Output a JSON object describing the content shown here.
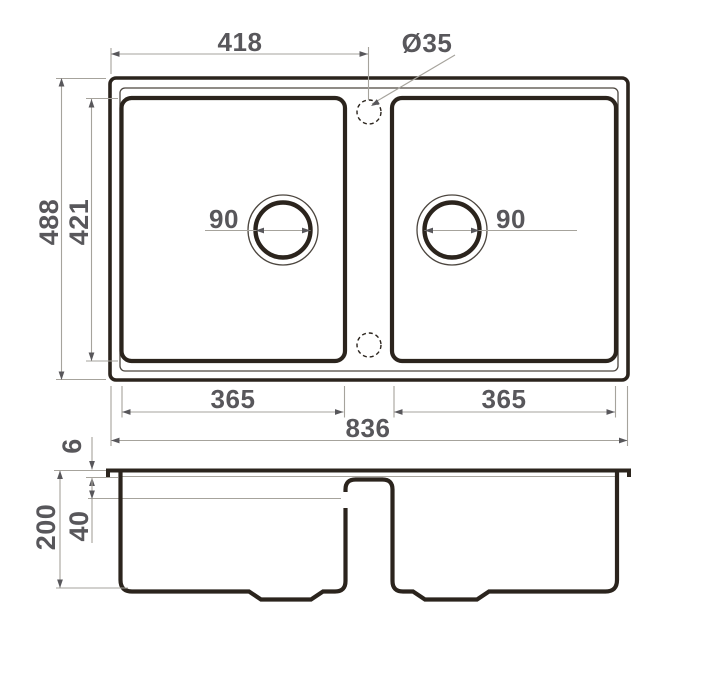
{
  "drawing": {
    "colors": {
      "outline": "#2b241d",
      "dim_text": "#58575b",
      "dim_line": "#a6a39c",
      "background": "#ffffff"
    },
    "top_view": {
      "dim_left_edge_to_hole_center": "418",
      "tap_hole_diameter": "Ø35",
      "dim_overall_depth": "488",
      "dim_bowl_inner_depth": "421",
      "dim_left_drain_diameter": "90",
      "dim_right_drain_diameter": "90",
      "dim_left_bowl_width": "365",
      "dim_right_bowl_width": "365",
      "dim_overall_width": "836"
    },
    "section_view": {
      "dim_rim_thickness": "6",
      "dim_upper_ledge_depth": "40",
      "dim_overall_height": "200"
    }
  }
}
